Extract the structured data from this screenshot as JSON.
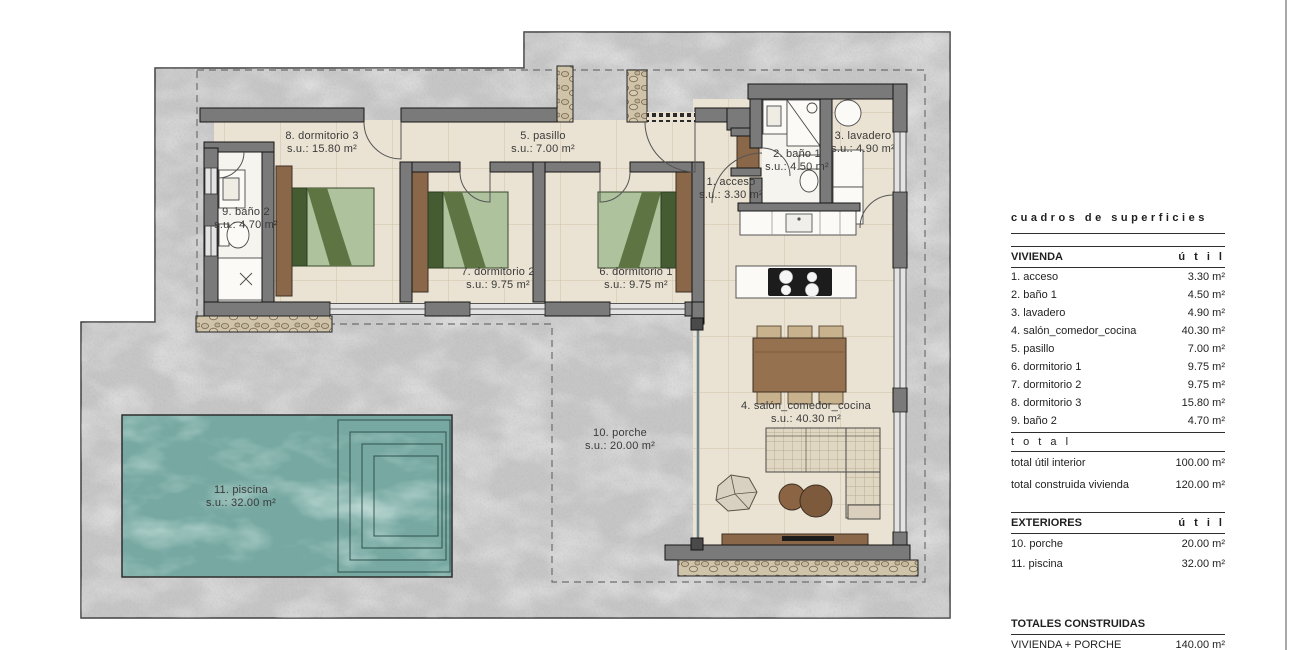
{
  "plan": {
    "labels": [
      {
        "id": "acceso",
        "name": "1. acceso",
        "area": "s.u.: 3.30 m²"
      },
      {
        "id": "bano1",
        "name": "2. baño 1",
        "area": "s.u.: 4.50 m²"
      },
      {
        "id": "lavadero",
        "name": "3. lavadero",
        "area": "s.u.: 4.90 m²"
      },
      {
        "id": "salon",
        "name": "4. salón_comedor_cocina",
        "area": "s.u.: 40.30 m²"
      },
      {
        "id": "pasillo",
        "name": "5. pasillo",
        "area": "s.u.: 7.00 m²"
      },
      {
        "id": "dorm1",
        "name": "6. dormitorio 1",
        "area": "s.u.: 9.75 m²"
      },
      {
        "id": "dorm2",
        "name": "7. dormitorio 2",
        "area": "s.u.: 9.75 m²"
      },
      {
        "id": "dorm3",
        "name": "8. dormitorio 3",
        "area": "s.u.: 15.80 m²"
      },
      {
        "id": "bano2",
        "name": "9. baño 2",
        "area": "s.u.: 4.70 m²"
      },
      {
        "id": "porche",
        "name": "10. porche",
        "area": "s.u.: 20.00 m²"
      },
      {
        "id": "piscina",
        "name": "11. piscina",
        "area": "s.u.: 32.00 m²"
      }
    ]
  },
  "table": {
    "title": "cuadros de superficies",
    "vivienda": {
      "header": "VIVIENDA",
      "col": "ú t i l",
      "rows": [
        {
          "label": "1. acceso",
          "value": "3.30 m²"
        },
        {
          "label": "2. baño 1",
          "value": "4.50 m²"
        },
        {
          "label": "3. lavadero",
          "value": "4.90 m²"
        },
        {
          "label": "4. salón_comedor_cocina",
          "value": "40.30 m²"
        },
        {
          "label": "5. pasillo",
          "value": "7.00 m²"
        },
        {
          "label": "6. dormitorio 1",
          "value": "9.75 m²"
        },
        {
          "label": "7. dormitorio 2",
          "value": "9.75 m²"
        },
        {
          "label": "8. dormitorio 3",
          "value": "15.80 m²"
        },
        {
          "label": "9. baño 2",
          "value": "4.70 m²"
        }
      ]
    },
    "total_row": "t o t a l",
    "totals": [
      {
        "label": "total útil interior",
        "value": "100.00 m²"
      },
      {
        "label": "total construida vivienda",
        "value": "120.00 m²"
      }
    ],
    "exteriores": {
      "header": "EXTERIORES",
      "col": "ú t i l",
      "rows": [
        {
          "label": "10. porche",
          "value": "20.00 m²"
        },
        {
          "label": "11. piscina",
          "value": "32.00 m²"
        }
      ]
    },
    "totales_construidas": {
      "header": "TOTALES CONSTRUIDAS",
      "rows": [
        {
          "label": "VIVIENDA + PORCHE",
          "value": "140.00 m²"
        }
      ]
    }
  },
  "colors": {
    "concrete": "#c6c6c6",
    "wall": "#7a7a7a",
    "floor": "#eae2d2",
    "bath_floor": "#f6f4ef",
    "pool": "#77a9a2",
    "wood": "#8a6748",
    "light_wood": "#c8b28d",
    "bed_green": "#aec29d",
    "bed_green_dark": "#455c33",
    "outline": "#1a1a1a"
  }
}
